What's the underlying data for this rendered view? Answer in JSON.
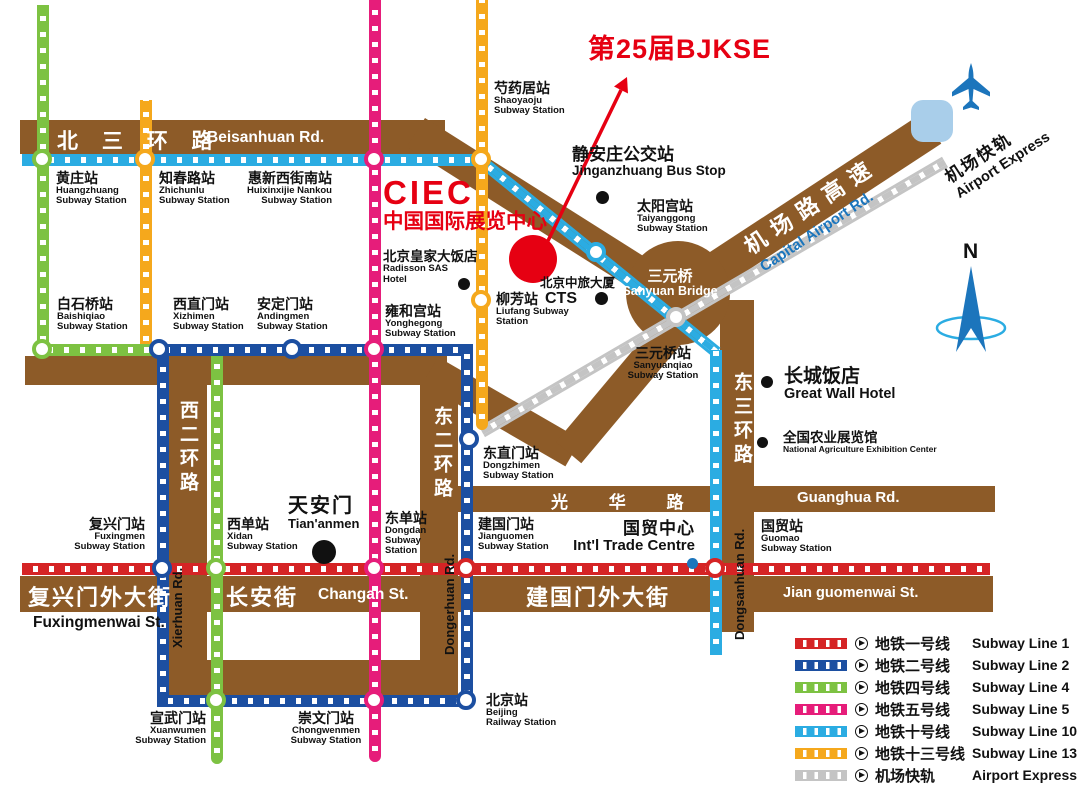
{
  "title": "第25届BJKSE",
  "ciec": {
    "abbr": "CIEC",
    "zh": "中国国际展览中心"
  },
  "compass_label": "N",
  "colors": {
    "road": "#8D5B28",
    "line1": "#D52425",
    "line2": "#1C4FA1",
    "line4": "#7DC242",
    "line5": "#E61D7A",
    "line10": "#2BACE2",
    "line13": "#F5A81C",
    "airport_express": "#C4C4C4",
    "accent": "#E60012",
    "plane": "#1C75BC",
    "terminal": "#A9CEEA",
    "capital_rd_text": "#1B75BC"
  },
  "roads": {
    "beisanhuan": {
      "zh": "北 三 环 路",
      "en": "Beisanhuan Rd."
    },
    "capital_airport": {
      "zh": "机场路高速",
      "en": "Capital Airport Rd."
    },
    "guanghua": {
      "zh": "光 华 路",
      "en": "Guanghua Rd."
    },
    "xierhuan": {
      "zh": "西二环路",
      "en": "Xierhuan Rd."
    },
    "dongerhuan": {
      "zh": "东二环路",
      "en": "Dongerhuan Rd."
    },
    "dongsanhuan": {
      "zh": "东三环路",
      "en": "Dongsanhuan Rd."
    },
    "fuxingmenwai": {
      "zh": "复兴门外大街",
      "en": "Fuxingmenwai St."
    },
    "changan": {
      "zh": "长安街",
      "en": "Changan St."
    },
    "jianguomenwai": {
      "zh": "建国门外大街",
      "en": "Jian guomenwai St."
    }
  },
  "airport_express_label": {
    "zh": "机场快轨",
    "en": "Airport Express"
  },
  "stations": {
    "shaoyaoju": {
      "zh": "芍药居站",
      "en1": "Shaoyaoju",
      "en2": "Subway Station"
    },
    "huangzhuang": {
      "zh": "黄庄站",
      "en1": "Huangzhuang",
      "en2": "Subway Station"
    },
    "zhichunlu": {
      "zh": "知春路站",
      "en1": "Zhichunlu",
      "en2": "Subway Station"
    },
    "huixinxijie": {
      "zh": "惠新西街南站",
      "en1": "Huixinxijie Nankou",
      "en2": "Subway Station"
    },
    "baishiqiao": {
      "zh": "白石桥站",
      "en1": "Baishiqiao",
      "en2": "Subway Station"
    },
    "xizhimen": {
      "zh": "西直门站",
      "en1": "Xizhimen",
      "en2": "Subway Station"
    },
    "andingmen": {
      "zh": "安定门站",
      "en1": "Andingmen",
      "en2": "Subway Station"
    },
    "yonghegong": {
      "zh": "雍和宫站",
      "en1": "Yonghegong",
      "en2": "Subway Station"
    },
    "liufang": {
      "zh": "柳芳站",
      "en1": "Liufang Subway",
      "en2": "Station"
    },
    "dongzhimen": {
      "zh": "东直门站",
      "en1": "Dongzhimen",
      "en2": "Subway Station"
    },
    "sanyuanqiao": {
      "zh": "三元桥站",
      "en1": "Sanyuanqiao",
      "en2": "Subway Station"
    },
    "taiyanggong": {
      "zh": "太阳宫站",
      "en1": "Taiyanggong",
      "en2": "Subway Station"
    },
    "fuxingmen": {
      "zh": "复兴门站",
      "en1": "Fuxingmen",
      "en2": "Subway Station"
    },
    "xidan": {
      "zh": "西单站",
      "en1": "Xidan",
      "en2": "Subway Station"
    },
    "dongdan": {
      "zh": "东单站",
      "en1": "Dongdan",
      "en2": "Subway",
      "en3": "Station"
    },
    "jianguomen": {
      "zh": "建国门站",
      "en1": "Jianguomen",
      "en2": "Subway Station"
    },
    "guomao": {
      "zh": "国贸站",
      "en1": "Guomao",
      "en2": "Subway Station"
    },
    "xuanwumen": {
      "zh": "宣武门站",
      "en1": "Xuanwumen",
      "en2": "Subway Station"
    },
    "chongwenmen": {
      "zh": "崇文门站",
      "en1": "Chongwenmen",
      "en2": "Subway Station"
    },
    "beijing_railway": {
      "zh": "北京站",
      "en1": "Beijing",
      "en2": "Railway Station"
    }
  },
  "pois": {
    "jinganzhuang": {
      "zh": "静安庄公交站",
      "en": "Jinganzhuang Bus Stop"
    },
    "radisson": {
      "zh": "北京皇家大饭店",
      "en1": "Radisson SAS",
      "en2": "Hotel"
    },
    "cts": {
      "zh": "北京中旅大厦",
      "en": "CTS"
    },
    "sanyuan_bridge": {
      "zh": "三元桥",
      "en": "Sanyuan Bridge"
    },
    "great_wall": {
      "zh": "长城饭店",
      "en": "Great Wall Hotel"
    },
    "agri_center": {
      "zh": "全国农业展览馆",
      "en": "National Agriculture Exhibition Center"
    },
    "tiananmen": {
      "zh": "天安门",
      "en": "Tian'anmen"
    },
    "intl_trade": {
      "zh": "国贸中心",
      "en": "Int'l Trade Centre"
    }
  },
  "legend": [
    {
      "id": "line1",
      "zh": "地铁一号线",
      "en": "Subway Line 1"
    },
    {
      "id": "line2",
      "zh": "地铁二号线",
      "en": "Subway Line 2"
    },
    {
      "id": "line4",
      "zh": "地铁四号线",
      "en": "Subway Line 4"
    },
    {
      "id": "line5",
      "zh": "地铁五号线",
      "en": "Subway Line 5"
    },
    {
      "id": "line10",
      "zh": "地铁十号线",
      "en": "Subway Line 10"
    },
    {
      "id": "line13",
      "zh": "地铁十三号线",
      "en": "Subway Line 13"
    },
    {
      "id": "airport",
      "zh": "机场快轨",
      "en": "Airport Express"
    }
  ]
}
